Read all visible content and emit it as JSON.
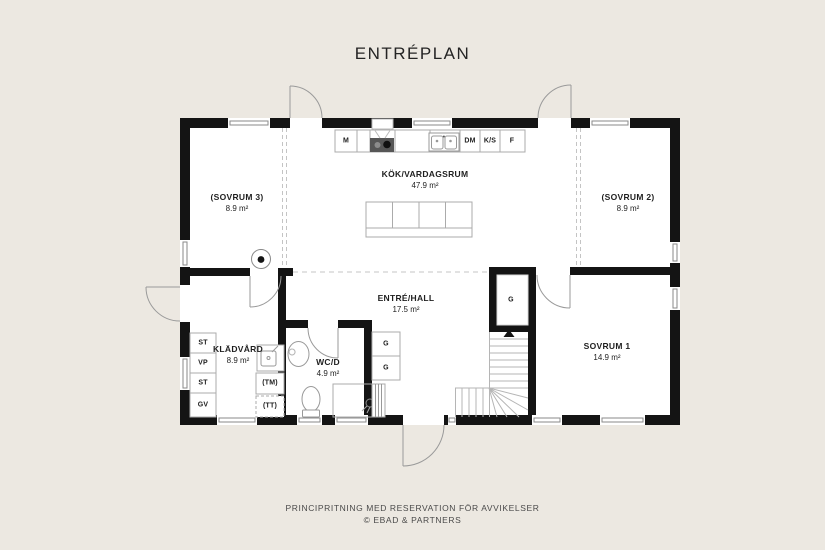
{
  "title": "ENTRÉPLAN",
  "rooms": {
    "kitchen_living": {
      "name": "KÖK/VARDAGSRUM",
      "area": "47.9 m²"
    },
    "bedroom3": {
      "name": "(SOVRUM 3)",
      "area": "8.9 m²"
    },
    "bedroom2": {
      "name": "(SOVRUM 2)",
      "area": "8.9 m²"
    },
    "hall": {
      "name": "ENTRÉ/HALL",
      "area": "17.5 m²"
    },
    "laundry": {
      "name": "KLÄDVÅRD",
      "area": "8.9 m²"
    },
    "wc_shower": {
      "name": "WC/D",
      "area": "4.9 m²"
    },
    "bedroom1": {
      "name": "SOVRUM 1",
      "area": "14.9 m²"
    }
  },
  "kitchen_appliances": {
    "m": "M",
    "dm": "DM",
    "ks": "K/S",
    "f": "F"
  },
  "laundry_fixtures": {
    "st_upper": "ST",
    "vp": "VP",
    "st_lower": "ST",
    "gv": "GV",
    "tm": "(TM)",
    "tt": "(TT)"
  },
  "wardrobe": {
    "label": "G"
  },
  "footer": {
    "disclaimer": "PRINCIPRITNING MED RESERVATION FÖR AVVIKELSER",
    "credit": "© EBAD & PARTNERS"
  },
  "colors": {
    "background": "#ece8e1",
    "wall": "#141414",
    "floor": "#ffffff",
    "thin_line": "#a5a5a5",
    "text": "#242424"
  }
}
